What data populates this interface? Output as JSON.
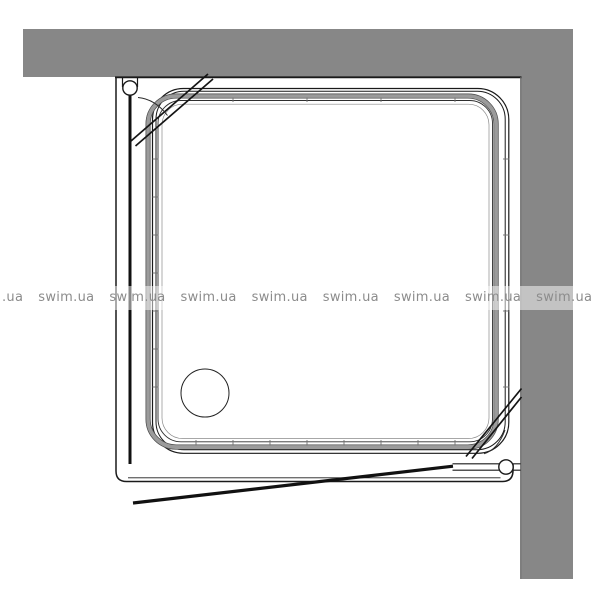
{
  "page": {
    "background_color": "#ffffff"
  },
  "watermark": {
    "text_color": "#8c8c8c",
    "band_background": "rgba(255,255,255,0.5)",
    "items": [
      ".ua",
      "swim.ua",
      "swim.ua",
      "swim.ua",
      "swim.ua",
      "swim.ua",
      "swim.ua",
      "swim.ua",
      "swim.ua",
      "swim.ua"
    ]
  },
  "drawing": {
    "type": "technical-top-view",
    "subject": "square shower tray with door, installed in wall corner",
    "wall_color": "#878787",
    "line_color": "#1a1a1a",
    "chamfer_shade_color": "#9b9b9b"
  }
}
